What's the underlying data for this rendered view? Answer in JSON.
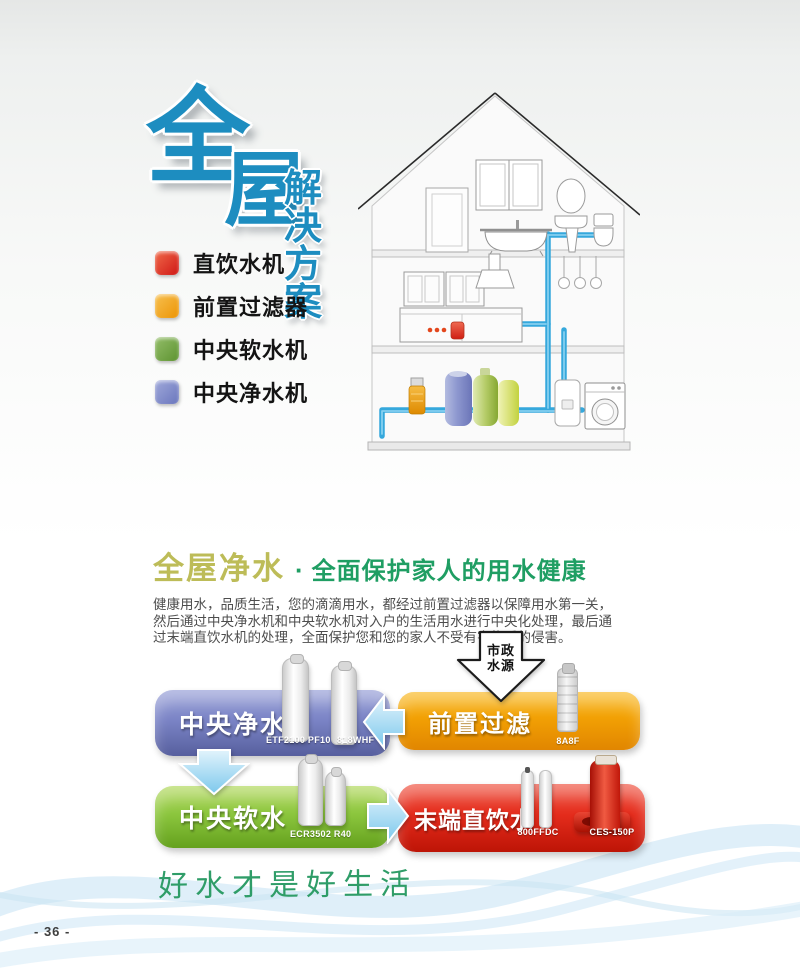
{
  "title": {
    "char_top": "全",
    "char_bottom": "屋",
    "subtitle": "解决方案"
  },
  "legend": {
    "items": [
      {
        "label": "直饮水机",
        "color": "#d8281f"
      },
      {
        "label": "前置过滤器",
        "color": "#f09c0a"
      },
      {
        "label": "中央软水机",
        "color": "#6fa33c"
      },
      {
        "label": "中央净水机",
        "color": "#7d87c5"
      }
    ]
  },
  "intro": {
    "heading_primary": "全屋净水",
    "heading_separator": "·",
    "heading_secondary": "全面保护家人的用水健康",
    "body_lines": [
      "健康用水，品质生活，您的滴滴用水，都经过前置过滤器以保障用水第一关，",
      "然后通过中央净水机和中央软水机对入户的生活用水进行中央化处理，最后通",
      "过末端直饮水机的处理，全面保护您和您的家人不受有害物质的侵害。"
    ]
  },
  "flow": {
    "source_arrow": {
      "line1": "市政",
      "line2": "水源"
    },
    "central_pure": {
      "label": "中央净水",
      "model_a": "ETF2100 PF10",
      "model_b": "818WHF"
    },
    "pre_filter": {
      "label": "前置过滤",
      "model": "8A8F"
    },
    "central_soft": {
      "label": "中央软水",
      "model": "ECR3502 R40"
    },
    "terminal_drink": {
      "label": "末端直饮水",
      "model_a": "800FFDC",
      "model_b": "CES-150P"
    }
  },
  "slogan": "好水才是好生活",
  "footer": {
    "page_number": "- 36 -"
  },
  "colors": {
    "title_blue": "#1d8dc0",
    "banner_orange": "#f2a004",
    "banner_purple": "#7b84c6",
    "banner_green": "#8cc63e",
    "banner_red": "#e42c1c",
    "pipe_blue": "#35a8dc",
    "heading_olive": "#bdbc58",
    "heading_green": "#1f9e63",
    "slogan_green": "#2f9d68"
  }
}
